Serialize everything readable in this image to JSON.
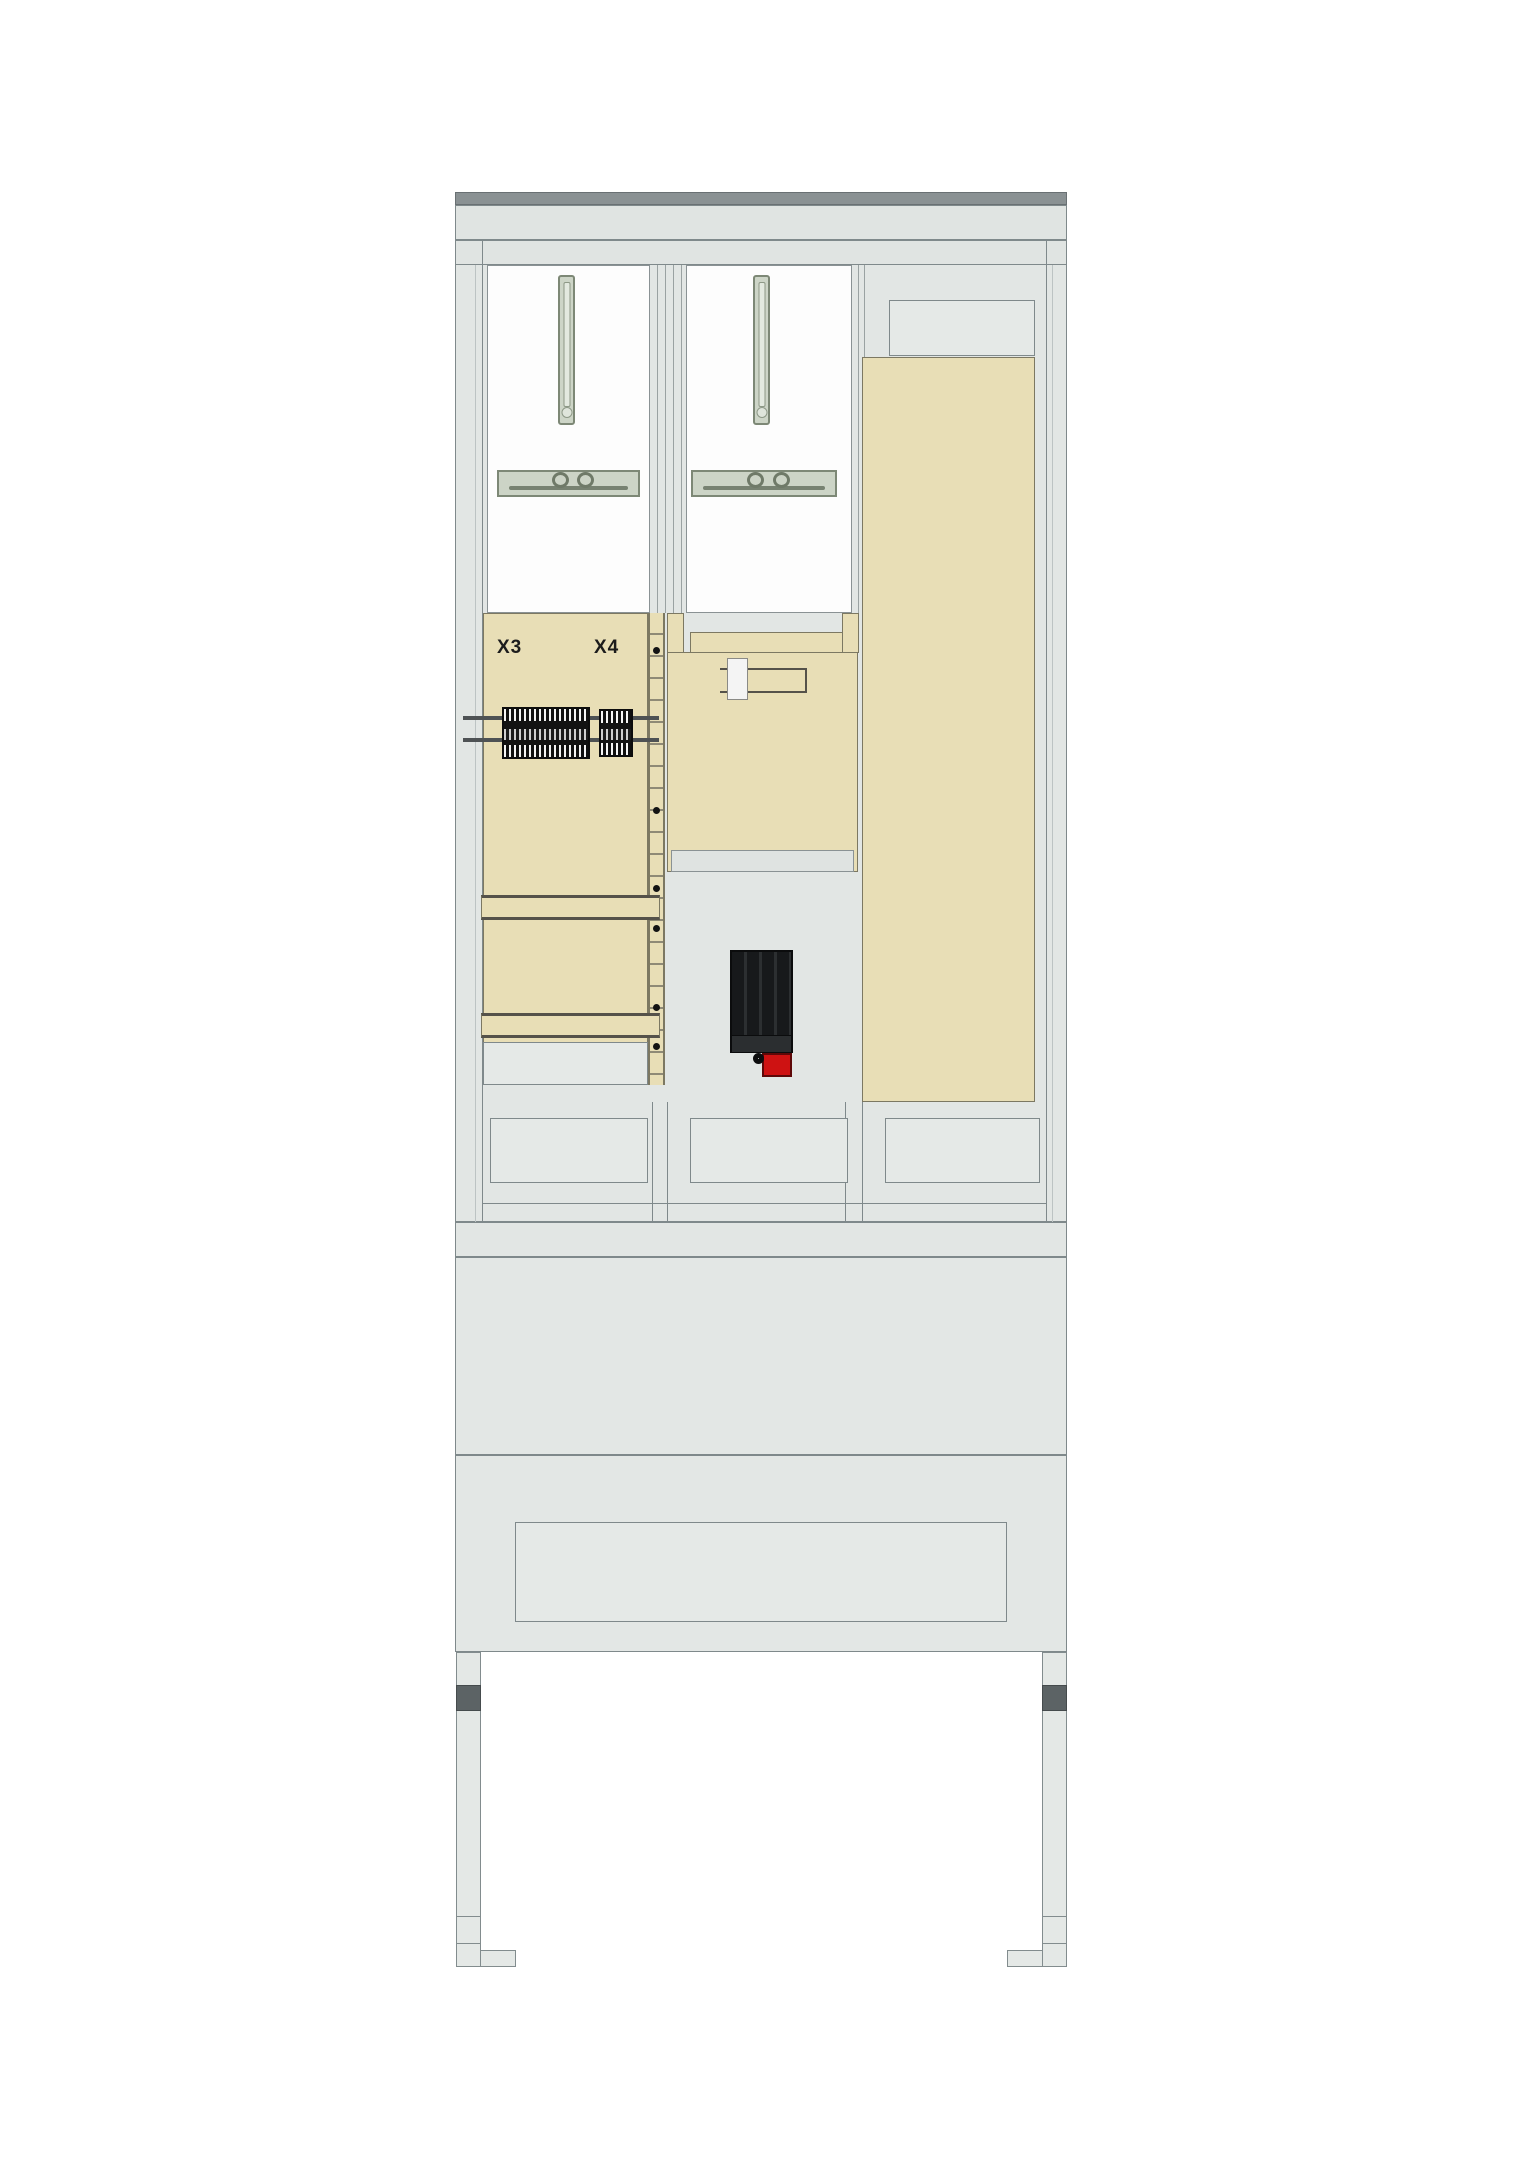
{
  "labels": {
    "terminal_block_left": "X3",
    "terminal_block_right": "X4"
  },
  "colors": {
    "beige": "#e8deb6",
    "beige-border": "#7c7862",
    "cabinet": "#e2e6e4",
    "cabinet-light": "#e5e9e7",
    "border": "#7f898b",
    "dark-bar": "#8a9193",
    "hardware": "#ccd4c6",
    "hardware-border": "#7d8876",
    "device-black": "#17191b",
    "switch-red": "#ce1212",
    "leg-dark": "#5c6365",
    "white-panel": "#fdfdfd"
  }
}
